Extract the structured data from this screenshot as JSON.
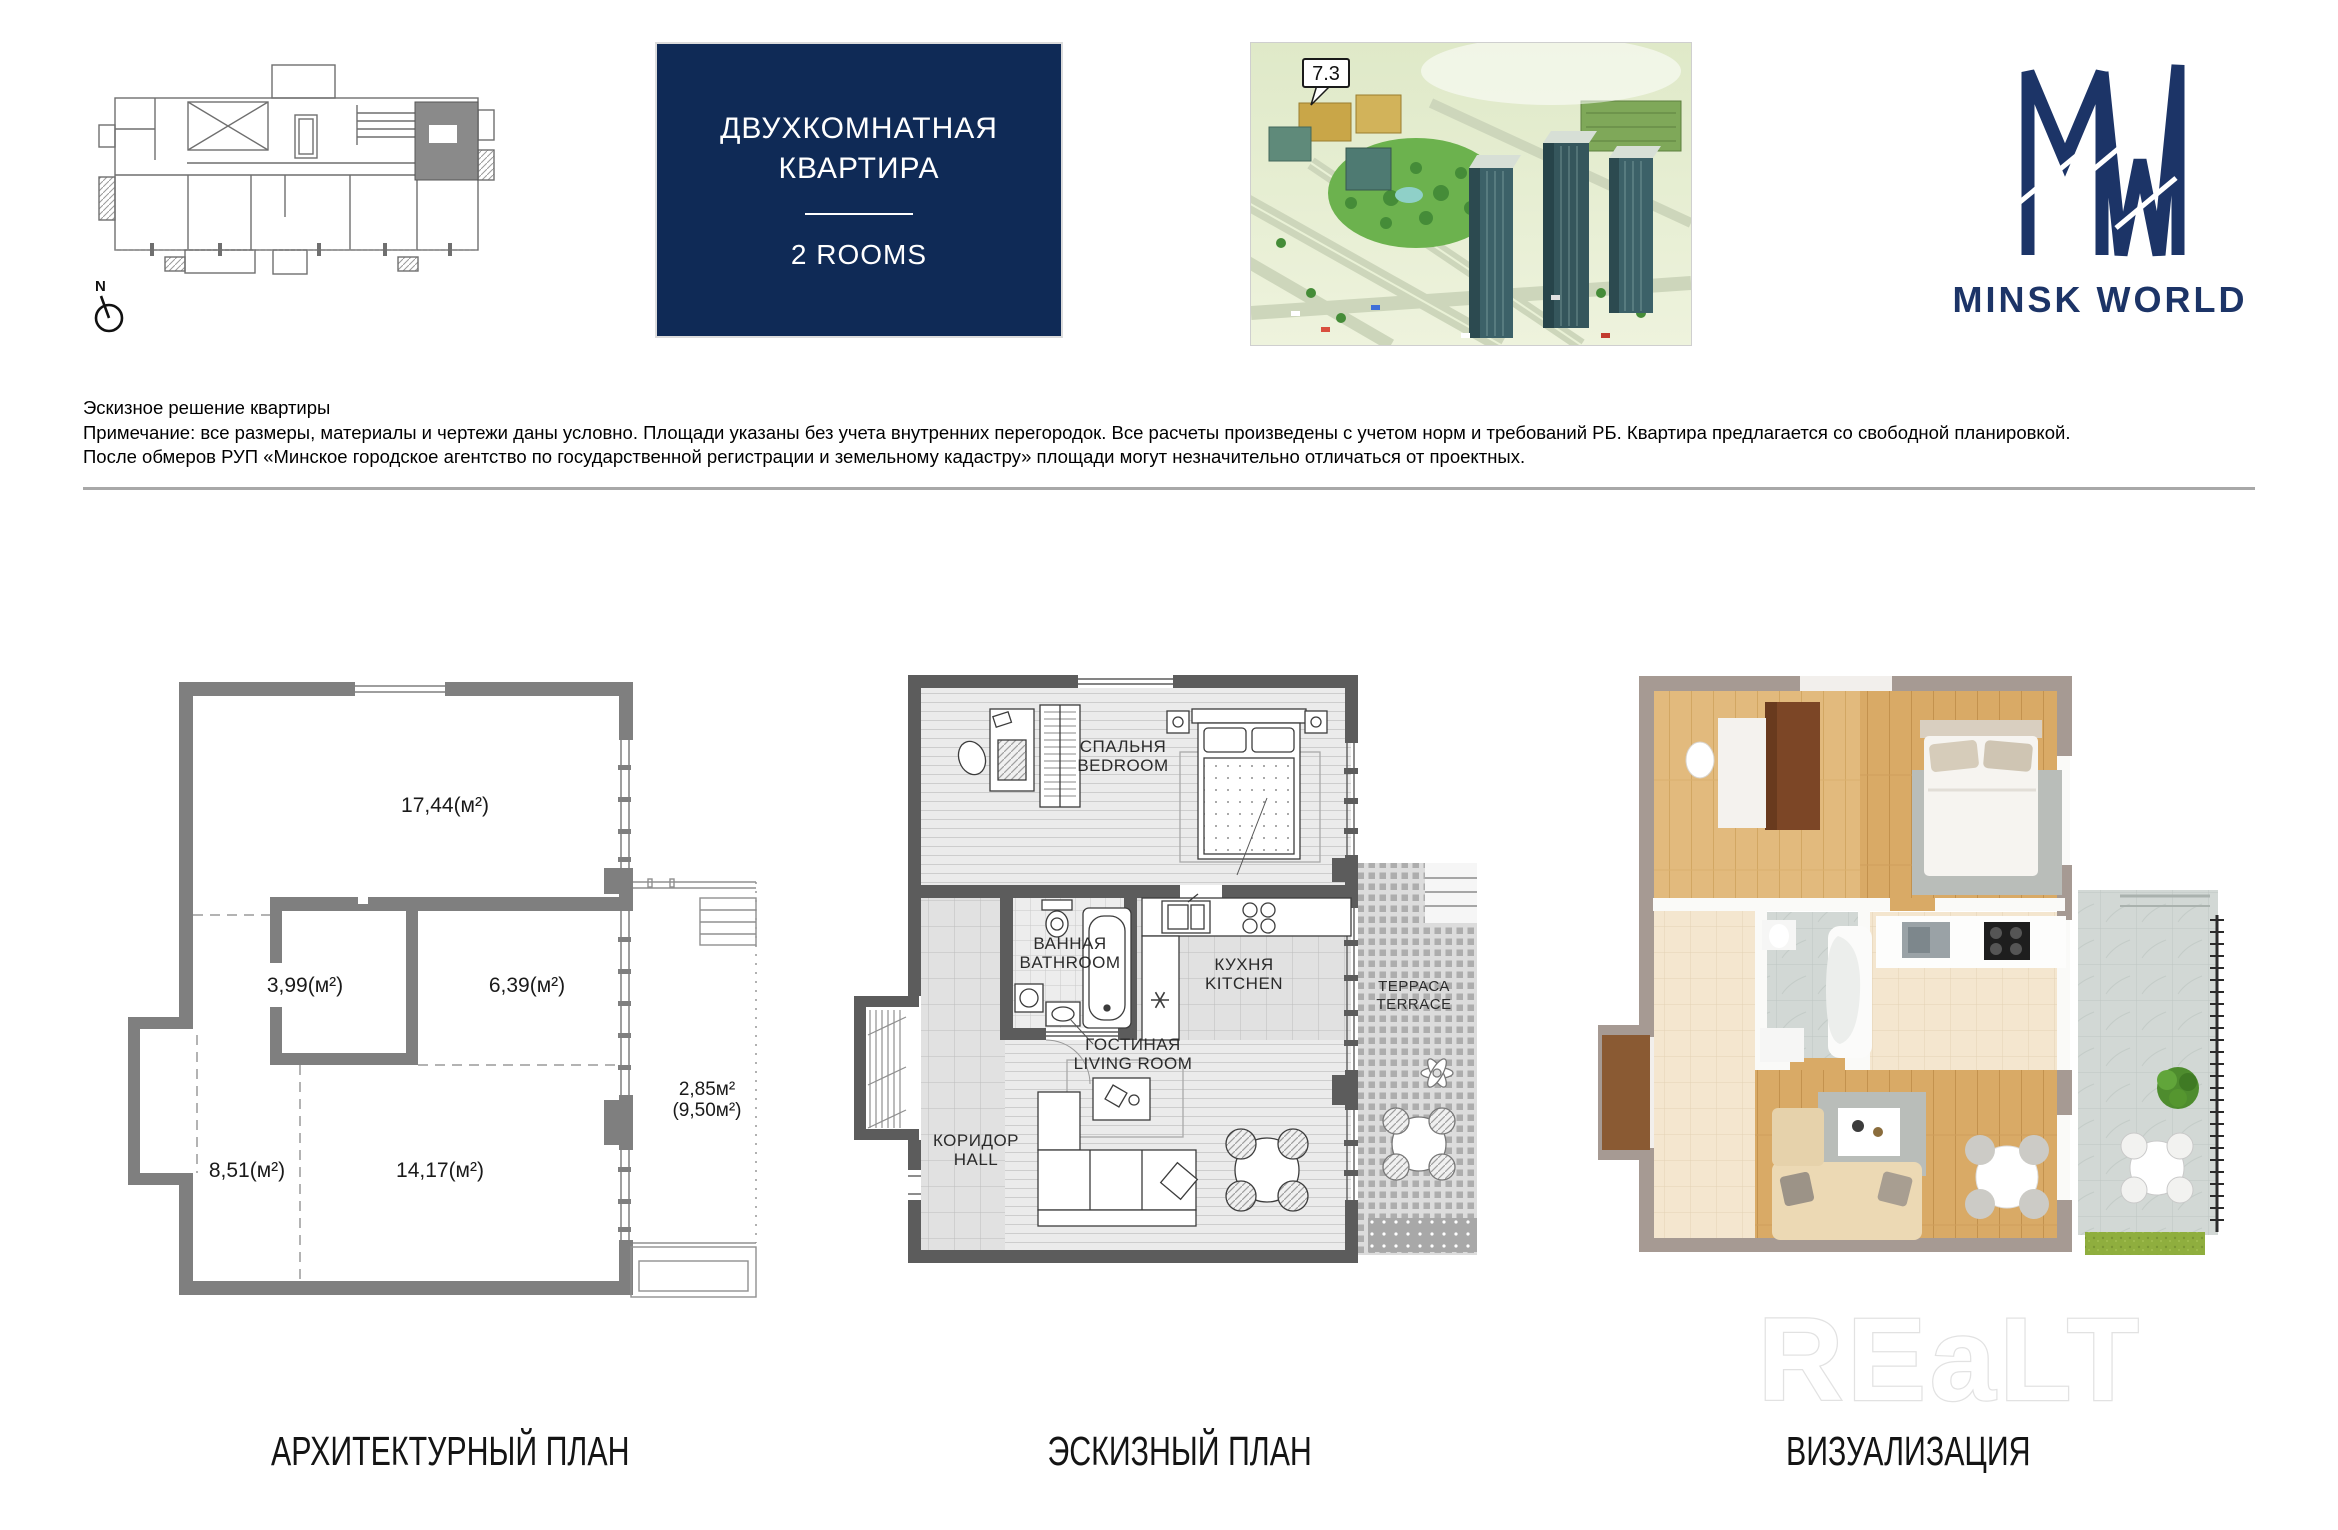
{
  "colors": {
    "title_card_bg": "#0f2a56",
    "brand_navy": "#1c3467",
    "arch_wall_gray": "#7f7f7f",
    "sketch_wall_gray": "#5c5c5c",
    "viz_wall_taupe": "#a69a93",
    "viz_wood": "#d9aa66"
  },
  "header": {
    "compass_label": "N",
    "title_card": {
      "line1": "ДВУХКОМНАТНАЯ",
      "line2": "КВАРТИРА",
      "subtitle": "2 ROOMS"
    },
    "aerial": {
      "building_label": "7.3"
    },
    "brand": {
      "wordmark": "MINSK WORLD"
    }
  },
  "disclaimer": {
    "line1": "Эскизное решение квартиры",
    "line2": "Примечание: все размеры, материалы и чертежи даны условно. Площади указаны без учета внутренних перегородок. Все расчеты произведены с учетом норм и требований РБ. Квартира предлагается со свободной планировкой.",
    "line3": "После обмеров РУП «Минское городское агентство по государственной регистрации и земельному кадастру» площади могут незначительно отличаться от проектных."
  },
  "architectural_plan": {
    "caption": "АРХИТЕКТУРНЫЙ ПЛАН",
    "areas": {
      "top_room": "17,44(м²)",
      "inner_room": "3,99(м²)",
      "right_room": "6,39(м²)",
      "bottom_left": "8,51(м²)",
      "bottom_room": "14,17(м²)",
      "terrace_actual": "2,85м²",
      "terrace_full": "(9,50м²)"
    }
  },
  "sketch_plan": {
    "caption": "ЭСКИЗНЫЙ ПЛАН",
    "rooms": {
      "bedroom": {
        "ru": "СПАЛЬНЯ",
        "en": "BEDROOM"
      },
      "bathroom": {
        "ru": "ВАННАЯ",
        "en": "BATHROOM"
      },
      "kitchen": {
        "ru": "КУХНЯ",
        "en": "KITCHEN"
      },
      "living_room": {
        "ru": "ГОСТИНАЯ",
        "en": "LIVING ROOM"
      },
      "hall": {
        "ru": "КОРИДОР",
        "en": "HALL"
      },
      "terrace": {
        "ru": "ТЕРРАСА",
        "en": "TERRACE"
      }
    }
  },
  "visualization": {
    "caption": "ВИЗУАЛИЗАЦИЯ"
  },
  "watermark": "REaLT"
}
